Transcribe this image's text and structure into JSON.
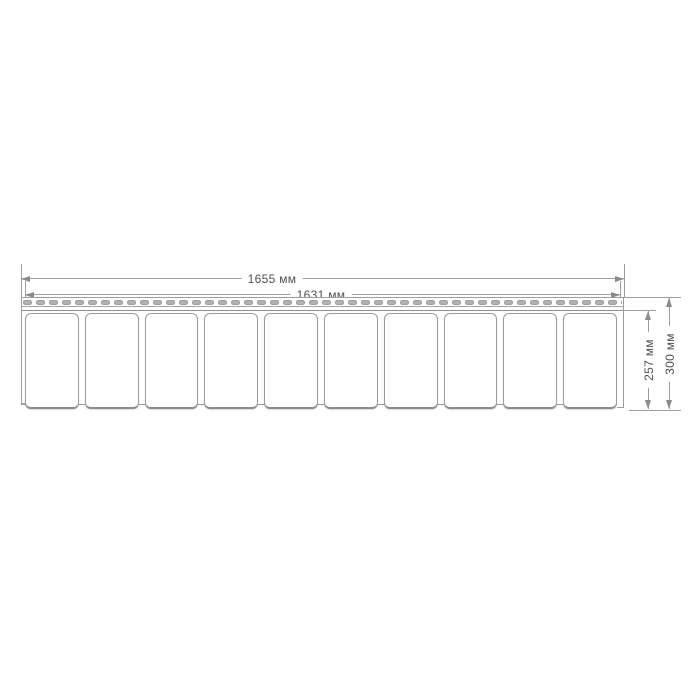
{
  "drawing": {
    "panel_sections": 10,
    "perforation_dashes": 47
  },
  "dimensions": {
    "outer_width": "1655 мм",
    "inner_width": "1631 мм",
    "inner_height": "257 мм",
    "outer_height": "300 мм"
  },
  "colors": {
    "background": "#ffffff",
    "line": "#9e9e9e",
    "arrow": "#8a8a8a",
    "panel_border": "#9c9c9c",
    "dash_fill": "#b2b2b2",
    "text": "#4f4f4f"
  }
}
